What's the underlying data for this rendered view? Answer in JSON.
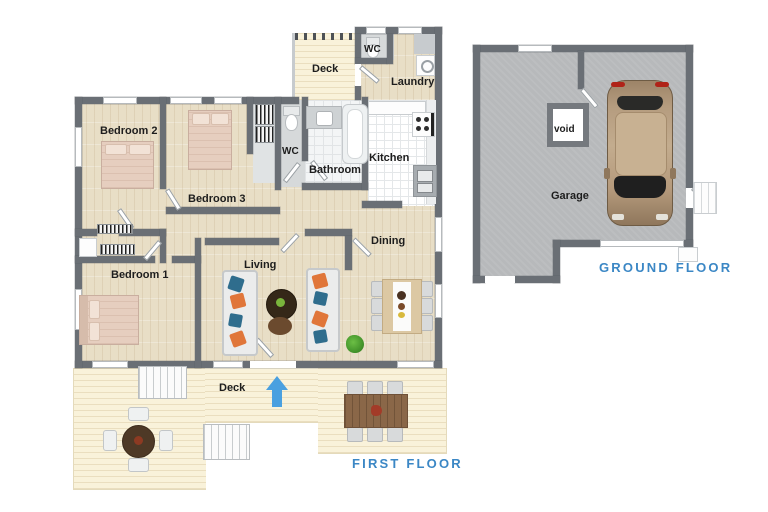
{
  "first_floor": {
    "title": "FIRST FLOOR",
    "rooms": {
      "bedroom1": "Bedroom 1",
      "bedroom2": "Bedroom 2",
      "bedroom3": "Bedroom 3",
      "living": "Living",
      "dining": "Dining",
      "kitchen": "Kitchen",
      "bathroom": "Bathroom",
      "wc_hall": "WC",
      "wc_entry": "WC",
      "laundry": "Laundry",
      "deck_upper": "Deck",
      "deck_lower": "Deck"
    }
  },
  "ground_floor": {
    "title": "GROUND FLOOR",
    "rooms": {
      "garage": "Garage",
      "void": "void"
    }
  },
  "colors": {
    "accent_blue": "#3b87c5",
    "wall": "#6a6f75",
    "wood_floor": "#e8dec6",
    "deck_floor": "#f9f2da",
    "tile_floor": "#ffffff",
    "garage_floor": "#b7b9bb",
    "room_label": "#1d1d1d"
  }
}
